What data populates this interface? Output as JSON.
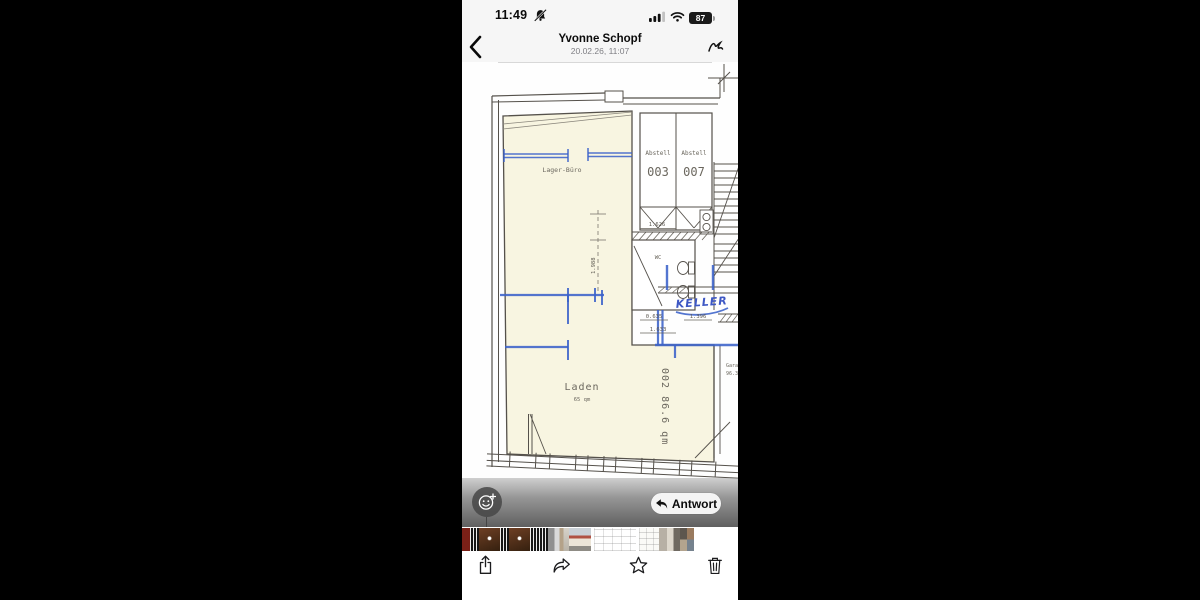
{
  "status_bar": {
    "time": "11:49",
    "battery_percent": "87"
  },
  "header": {
    "contact_name": "Yvonne Schopf",
    "message_timestamp": "20.02.26, 11:07"
  },
  "floor_plan": {
    "labels": {
      "lager_buero": "Lager-Büro",
      "abstell_left": "Abstell",
      "abstell_left_no": "003",
      "abstell_right": "Abstell",
      "abstell_right_no": "007",
      "wc": "WC",
      "keller_handwritten": "KELLER",
      "laden": "Laden",
      "laden_area": "65 qm",
      "unit_side": "002  86.6 qm",
      "garage": "Gara",
      "garage_area": "96.3"
    },
    "dimensions": {
      "abstell_width": "1.626",
      "room_height": "1.988",
      "wc_a": "0.635",
      "wc_b": "1.633",
      "keller_width": "1.396"
    },
    "annotation_color": "#3b62c9",
    "paper_room_fill": "#f8f5e1"
  },
  "overlay": {
    "reply_button": "Antwort"
  },
  "filmstrip": {
    "items": [
      {
        "type": "photo-red"
      },
      {
        "type": "audio"
      },
      {
        "type": "photo-door"
      },
      {
        "type": "audio"
      },
      {
        "type": "photo-door"
      },
      {
        "type": "audio"
      },
      {
        "type": "audio"
      },
      {
        "type": "photo-docs"
      },
      {
        "type": "photo-house"
      },
      {
        "type": "plan",
        "selected": true
      },
      {
        "type": "plan"
      },
      {
        "type": "photo-street"
      },
      {
        "type": "photo-grid"
      }
    ]
  },
  "toolbar": {
    "icons": [
      "share",
      "forward",
      "star",
      "trash"
    ]
  }
}
